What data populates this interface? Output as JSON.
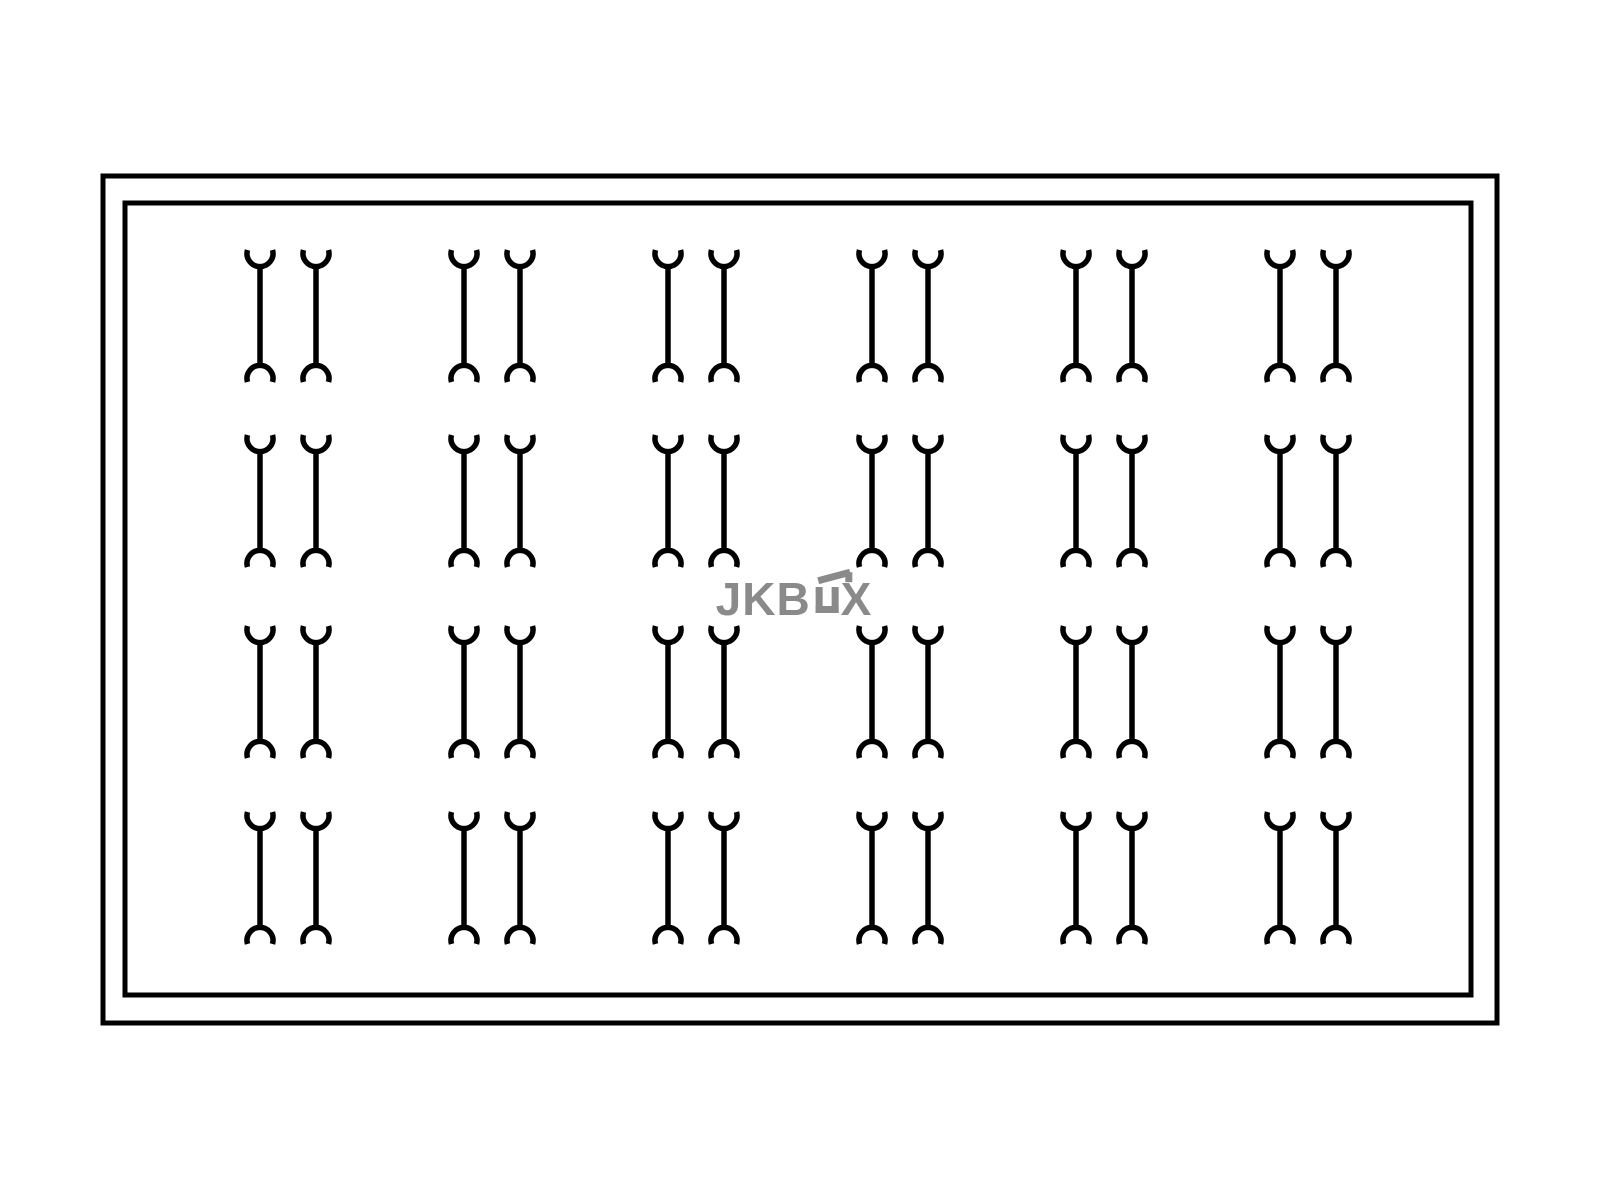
{
  "canvas": {
    "width": 1600,
    "height": 1200,
    "background": "#ffffff"
  },
  "drawing": {
    "outer_border": {
      "x": 103,
      "y": 176,
      "width": 1394,
      "height": 847,
      "stroke": "#000000",
      "stroke_width": 5
    },
    "inner_border": {
      "x": 125,
      "y": 203,
      "width": 1346,
      "height": 792,
      "stroke": "#000000",
      "stroke_width": 5
    }
  },
  "clip_grid": {
    "rows": 4,
    "columns": 6,
    "clips_per_cell": 2,
    "pair_center_x": [
      288,
      492,
      696,
      900,
      1104,
      1308
    ],
    "row_top_y": [
      250,
      435,
      626,
      812
    ],
    "pair_gap": 56,
    "element_height": 132,
    "arc_radius": 13,
    "arc_overhang_deg": 16,
    "stroke": "#000000",
    "stroke_width": 5.5
  },
  "watermark": {
    "full_text": "JKBOX",
    "text_before": "JKB",
    "text_after": "X",
    "box_glyph": "open-box-with-lid-icon",
    "color": "#8a8a8a"
  }
}
